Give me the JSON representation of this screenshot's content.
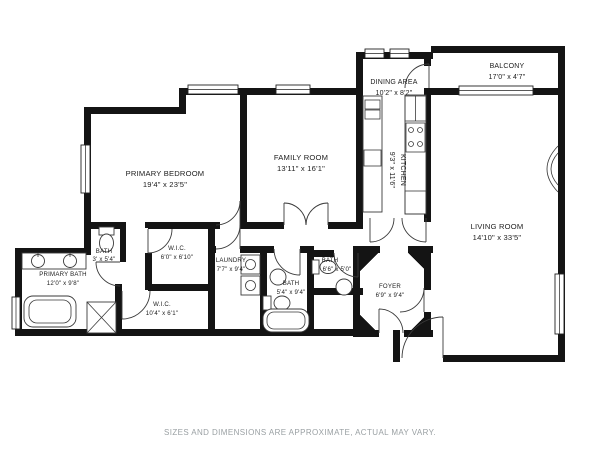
{
  "plan": {
    "rooms": [
      {
        "id": "primary-bedroom",
        "name": "PRIMARY BEDROOM",
        "dims": "19'4\" x 23'5\""
      },
      {
        "id": "family-room",
        "name": "FAMILY ROOM",
        "dims": "13'11\" x 16'1\""
      },
      {
        "id": "dining-area",
        "name": "DINING AREA",
        "dims": "10'2\" x 8'2\""
      },
      {
        "id": "balcony",
        "name": "BALCONY",
        "dims": "17'0\" x 4'7\""
      },
      {
        "id": "kitchen",
        "name": "KITCHEN",
        "dims": "9'3\" x 11'6\""
      },
      {
        "id": "living-room",
        "name": "LIVING ROOM",
        "dims": "14'10\" x 33'5\""
      },
      {
        "id": "bath-small",
        "name": "BATH",
        "dims": "3' x 5'4\""
      },
      {
        "id": "primary-bath",
        "name": "PRIMARY BATH",
        "dims": "12'0\" x 9'8\""
      },
      {
        "id": "wic-1",
        "name": "W.I.C.",
        "dims": "6'0\" x 6'10\""
      },
      {
        "id": "laundry",
        "name": "LAUNDRY",
        "dims": "7'7\" x 9'4\""
      },
      {
        "id": "bath-hall",
        "name": "BATH",
        "dims": "5'4\" x 9'4\""
      },
      {
        "id": "bath-guest",
        "name": "BATH",
        "dims": "6'6\" x 5'0\""
      },
      {
        "id": "foyer",
        "name": "FOYER",
        "dims": "6'9\" x 9'4\""
      },
      {
        "id": "wic-2",
        "name": "W.I.C.",
        "dims": "10'4\" x 6'1\""
      }
    ],
    "disclaimer": "SIZES AND DIMENSIONS ARE APPROXIMATE, ACTUAL MAY VARY.",
    "colors": {
      "wall": "#141414",
      "fixture": "#3a3a3a",
      "label": "#1c1c1c",
      "disclaimer": "#9aa0a3",
      "background": "#ffffff"
    }
  }
}
